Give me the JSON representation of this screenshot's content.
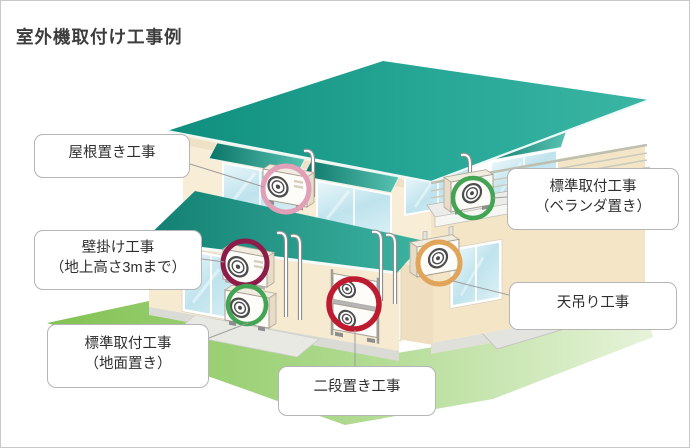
{
  "page": {
    "title": "室外機取付け工事例"
  },
  "colors": {
    "roof_teal": "#18978a",
    "awning_teal": "#0b7568",
    "wall_cream": "#f7ecd4",
    "lawn_green": "#8cc75f",
    "connector": "#9e9e9e",
    "label_border": "#b5b5b5"
  },
  "callouts": [
    {
      "id": "roof-mount",
      "lines": [
        "屋根置き工事"
      ],
      "ring": "#e2a0b8"
    },
    {
      "id": "veranda-standard",
      "lines": [
        "標準取付工事",
        "（ベランダ置き）"
      ],
      "ring": "#43a454"
    },
    {
      "id": "wall-mount",
      "lines": [
        "壁掛け工事",
        "（地上高さ3mまで）"
      ],
      "ring": "#8e1c49"
    },
    {
      "id": "ceiling-hang",
      "lines": [
        "天吊り工事"
      ],
      "ring": "#e0a558"
    },
    {
      "id": "ground-standard",
      "lines": [
        "標準取付工事",
        "（地面置き）"
      ],
      "ring": "#43a454"
    },
    {
      "id": "two-tier",
      "lines": [
        "二段置き工事"
      ],
      "ring": "#bf1b30"
    }
  ]
}
